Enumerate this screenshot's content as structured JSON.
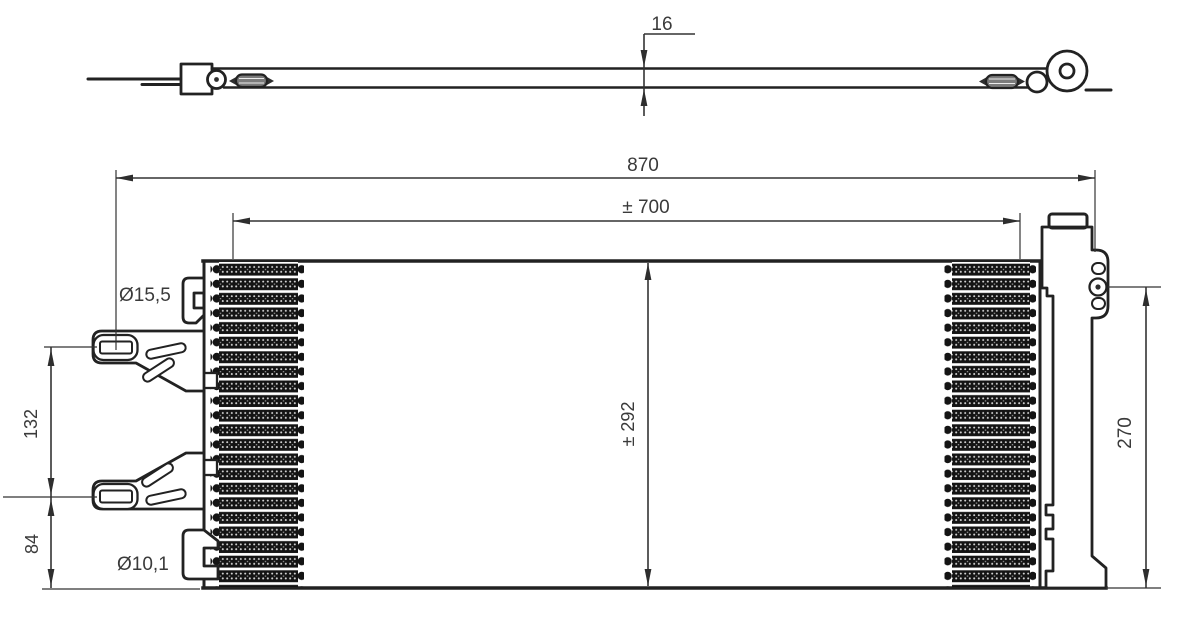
{
  "drawing": {
    "description": "condenser technical drawing",
    "colors": {
      "background": "#ffffff",
      "outline": "#222222",
      "dimension_line": "#333333",
      "text": "#3a3a3a",
      "fin_fill": "#141414"
    }
  },
  "dimensions": {
    "strip_thickness": "16",
    "overall_width": "870",
    "tube_length": "± 700",
    "core_height": "± 292",
    "drier_height": "270",
    "bracket_spacing": "132",
    "bracket_to_bottom": "84",
    "upper_bracket_hole": "Ø15,5",
    "lower_bracket_hole": "Ø10,1"
  }
}
